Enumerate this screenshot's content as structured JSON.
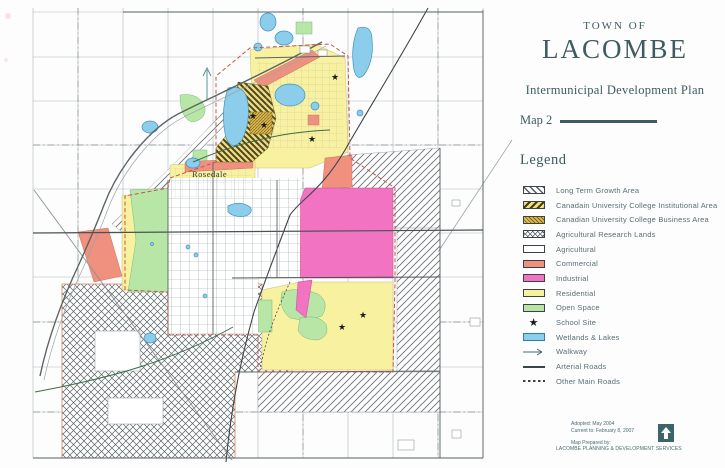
{
  "title_block": {
    "town_of": "TOWN OF",
    "town_name": "LACOMBE",
    "plan_title": "Intermunicipal Development Plan",
    "map_number": "Map 2"
  },
  "legend": {
    "heading": "Legend",
    "items": [
      {
        "label": "Long Term Growth Area",
        "swatch": "hatch-diagonal-white"
      },
      {
        "label": "Canadain University College Institutional Area",
        "swatch": "hatch-diagonal-yellow"
      },
      {
        "label": "Canadian University College Business Area",
        "swatch": "hatch-dense-gold"
      },
      {
        "label": "Agricultural Research Lands",
        "swatch": "crosshatch-white"
      },
      {
        "label": "Agricultural",
        "swatch": "plain-white"
      },
      {
        "label": "Commercial",
        "swatch": "solid",
        "color": "#f0907e"
      },
      {
        "label": "Industrial",
        "swatch": "solid",
        "color": "#f173c1"
      },
      {
        "label": "Residential",
        "swatch": "solid",
        "color": "#f8f1a0"
      },
      {
        "label": "Open Space",
        "swatch": "solid",
        "color": "#b7e6a6"
      },
      {
        "label": "School Site",
        "swatch": "star",
        "icon": "star-icon"
      },
      {
        "label": "Wetlands & Lakes",
        "swatch": "solid-water",
        "color": "#8ccdec"
      },
      {
        "label": "Walkway",
        "swatch": "arrow",
        "icon": "arrow-right-icon"
      },
      {
        "label": "Arterial Roads",
        "swatch": "line-solid"
      },
      {
        "label": "Other Main Roads",
        "swatch": "line-dashed"
      }
    ]
  },
  "map": {
    "labels": {
      "rosedale": "Rosedale"
    }
  },
  "footer": {
    "adopted": "Adopted: May 2004",
    "current_to": "Current to: February 8, 2007",
    "prepared_by": "Map Prepared by:",
    "agency": "LACOMBE PLANNING & DEVELOPMENT SERVICES",
    "logo_icon": "up-arrow-icon"
  },
  "colors": {
    "title_text": "#3d5b60",
    "legend_text": "#5a6e72",
    "commercial": "#f0907e",
    "industrial": "#f173c1",
    "residential": "#f8f1a0",
    "open_space": "#b7e6a6",
    "water": "#8ccdec",
    "logo_teal": "#3d6468"
  }
}
